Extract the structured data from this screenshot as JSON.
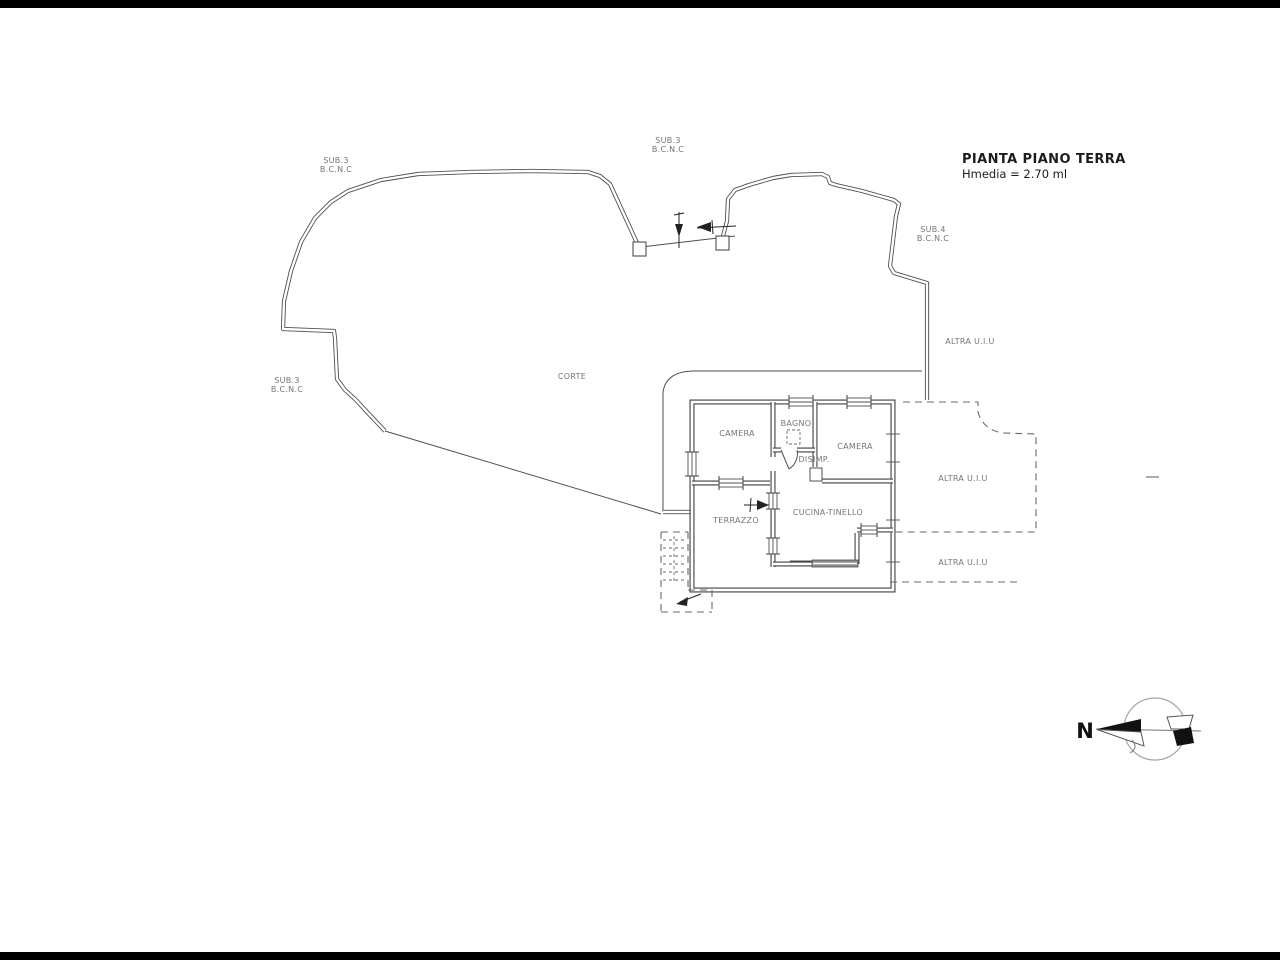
{
  "title": "PIANTA PIANO TERRA",
  "subtitle": "Hmedia = 2.70 ml",
  "parcels": {
    "top_left": {
      "id": "SUB.3",
      "class": "B.C.N.C"
    },
    "top_center": {
      "id": "SUB.3",
      "class": "B.C.N.C"
    },
    "right": {
      "id": "SUB.4",
      "class": "B.C.N.C"
    },
    "left": {
      "id": "SUB.3",
      "class": "B.C.N.C"
    }
  },
  "adjacent_units": {
    "upper_right": "ALTRA U.I.U",
    "middle_right": "ALTRA U.I.U",
    "lower_right": "ALTRA U.I.U"
  },
  "rooms": {
    "corte": "CORTE",
    "camera_left": "CAMERA",
    "bagno": "BAGNO",
    "disimpegno": "DISIMP.",
    "camera_right": "CAMERA",
    "cucina_tinello": "CUCINA-TINELLO",
    "terrazzo": "TERRAZZO"
  },
  "compass": {
    "north": "N"
  },
  "colors": {
    "wall": "#4f4f4f",
    "label": "#757575",
    "title": "#1c1c1c",
    "background": "#ffffff"
  }
}
